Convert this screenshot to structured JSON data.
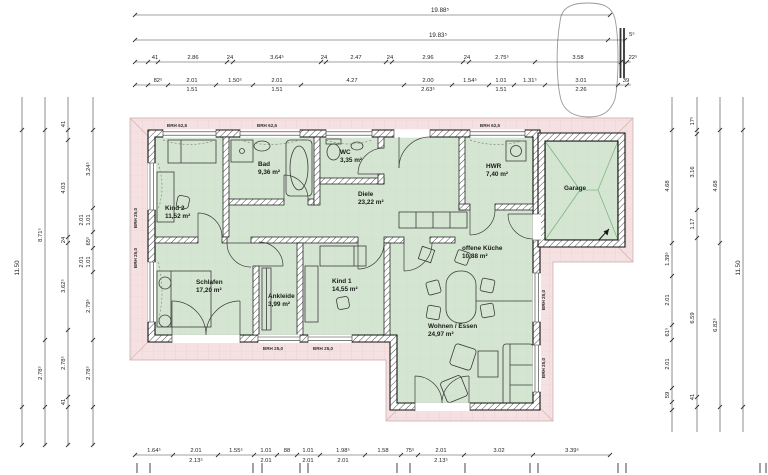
{
  "colors": {
    "roof_pink": "#f5e1e1",
    "room_green": "#d4e6d1",
    "garage_line": "#2e7d32",
    "wall_hatch": "#4a4a4a"
  },
  "rooms": {
    "kind2": {
      "name": "Kind 2",
      "area": "11,52 m²"
    },
    "bad": {
      "name": "Bad",
      "area": "9,36 m²"
    },
    "wc": {
      "name": "WC",
      "area": "3,35 m²"
    },
    "diele": {
      "name": "Diele",
      "area": "23,22 m²"
    },
    "hwr": {
      "name": "HWR",
      "area": "7,40 m²"
    },
    "garage": {
      "name": "Garage"
    },
    "schlafen": {
      "name": "Schlafen",
      "area": "17,20 m²"
    },
    "ankleide": {
      "name": "Ankleide",
      "area": "3,99 m²"
    },
    "kind1": {
      "name": "Kind 1",
      "area": "14,55 m²"
    },
    "kueche": {
      "name": "offene Küche",
      "area": "10,88 m²"
    },
    "wohnen": {
      "name": "Wohnen / Essen",
      "area": "24,97 m²"
    }
  },
  "brh": {
    "top": "BRH 62,5",
    "low": "BRH 25,0"
  },
  "dims": {
    "top1": "19.88⁵",
    "top2": "19.83⁵",
    "top2r": "5⁵",
    "top3": [
      "41",
      "2.86",
      "24",
      "3.64⁵",
      "24",
      "2.47",
      "24",
      "2.96",
      "24",
      "2.75⁵",
      "3.58",
      "22⁵"
    ],
    "top4": [
      {
        "a": "82⁵"
      },
      {
        "a": "2.01",
        "b": "1.51"
      },
      {
        "a": "1.50⁵"
      },
      {
        "a": "2.01",
        "b": "1.51"
      },
      {
        "a": "4.27"
      },
      {
        "a": "2.00",
        "b": "2.63⁵"
      },
      {
        "a": "1.54⁵"
      },
      {
        "a": "1.01",
        "b": "1.51"
      },
      {
        "a": "1.31⁵"
      },
      {
        "a": "3.01",
        "b": "2.26"
      },
      {
        "a": "39"
      }
    ],
    "left1": [
      {
        "a": "3.24⁵"
      },
      {
        "a": "1.01",
        "b": "2.01"
      },
      {
        "a": "65⁵"
      },
      {
        "a": "1.01",
        "b": "2.01"
      },
      {
        "a": "2.79⁵"
      },
      {
        "a": "2.78⁵"
      }
    ],
    "left2": [
      "41",
      "4.03",
      "24",
      "3.62⁵",
      "2.78⁵",
      "41"
    ],
    "left3": [
      "8.71⁵",
      "2.78⁵"
    ],
    "left4": "11.50",
    "right1": [
      "4.68",
      "1.39⁵",
      "2.01",
      "61⁵",
      "2.01",
      "59"
    ],
    "right2": [
      "17⁵",
      "3.16",
      "1.17",
      "6.59",
      "41"
    ],
    "right3": [
      "4.68",
      "6.82⁵"
    ],
    "right4": "11.50",
    "bottom": [
      {
        "a": "1.64⁵"
      },
      {
        "a": "2.01",
        "b": "2.13⁵"
      },
      {
        "a": "1.55⁵"
      },
      {
        "a": "1.01",
        "b": "2.01"
      },
      {
        "a": "88"
      },
      {
        "a": "1.01",
        "b": "2.01"
      },
      {
        "a": "1.98⁵",
        "b": "2.01"
      },
      {
        "a": "1.58"
      },
      {
        "a": "75⁵"
      },
      {
        "a": "2.01",
        "b": "2.13⁵"
      },
      {
        "a": "3.02"
      },
      {
        "a": "3.39⁵"
      }
    ]
  }
}
